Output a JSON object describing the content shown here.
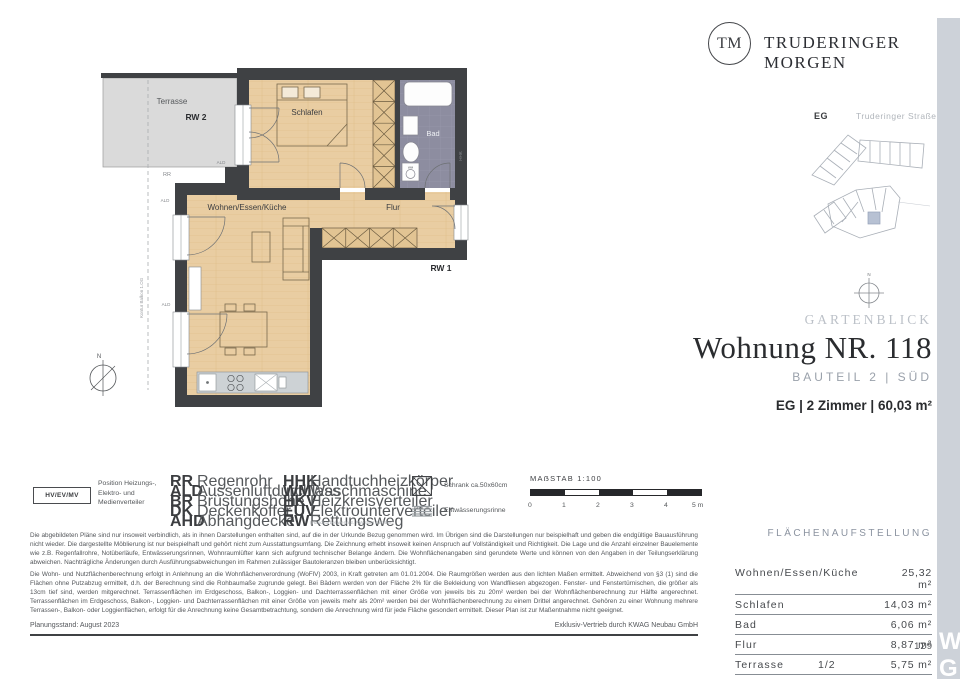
{
  "brand": {
    "initials": "TM",
    "name": "TRUDERINGER MORGEN"
  },
  "sitemap": {
    "floor": "EG",
    "street": "Truderinger Straße"
  },
  "title_block": {
    "category": "GARTENBLICK",
    "title": "Wohnung NR. 118",
    "subtitle": "BAUTEIL 2 | SÜD",
    "summary": "EG | 2 Zimmer | 60,03 m²"
  },
  "plan": {
    "terrasse": "Terrasse",
    "rw2": "RW 2",
    "schlafen": "Schlafen",
    "bad": "Bad",
    "wohnen": "Wohnen/Essen/Küche",
    "flur": "Flur",
    "rw1": "RW 1",
    "rr": "RR",
    "ald": "ALD",
    "wm": "WM",
    "hhk": "HHK",
    "north": "N",
    "kontur": "Kontur Balkon 1.OG"
  },
  "legend": {
    "hv_box": "HV/EV/MV",
    "hv_label_1": "Position Heizungs-,",
    "hv_label_2": "Elektro- und",
    "hv_label_3": "Medienverteiler",
    "col1": [
      {
        "a": "RR",
        "t": "Regenrohr"
      },
      {
        "a": "ALD",
        "t": "Aussenluftdurchlass"
      },
      {
        "a": "BR",
        "t": "Brüstungshöhe"
      },
      {
        "a": "DK",
        "t": "Deckenkoffer"
      },
      {
        "a": "AHD",
        "t": "Abhangdecke"
      }
    ],
    "col2": [
      {
        "a": "HHK",
        "t": "Handtuchheizkörper"
      },
      {
        "a": "WM",
        "t": "Waschmaschine"
      },
      {
        "a": "HKV",
        "t": "Heizkreisverteiler"
      },
      {
        "a": "EUV",
        "t": "Elektrounterverteiler"
      },
      {
        "a": "RW",
        "t": "Rettungsweg"
      }
    ],
    "rw_note": "(Handkurbel wenn 2. RW über Fenster)",
    "schrank": "Schrank ca.50x60cm",
    "rinne": "Entwässerungsrinne",
    "scale_title": "MAẞSTAB 1:100",
    "ticks": [
      "0",
      "1",
      "2",
      "3",
      "4",
      "5 m"
    ]
  },
  "disclaimer": {
    "p1": "Die abgebildeten Pläne sind nur insoweit verbindlich, als in ihnen Darstellungen enthalten sind, auf die in der Urkunde Bezug genommen wird. Im Übrigen sind die Darstellungen nur beispielhaft und geben die endgültige Bauausführung nicht wieder. Die dargestellte Möblierung ist nur beispielhaft und gehört nicht zum Ausstattungsumfang. Die Zeichnung erhebt insoweit keinen Anspruch auf Vollständigkeit und Richtigkeit. Die Lage und die Anzahl einzelner Bauelemente wie z.B. Regenfallrohre, Notüberläufe, Entwässerungsrinnen, Wohnraumlüfter kann sich aufgrund technischer Belange ändern. Die Wohnflächenangaben sind gerundete Werte und können von den Angaben in der Teilungserklärung abweichen. Nachträgliche Änderungen durch Ausführungsabweichungen im Rahmen zulässiger Bautoleranzen bleiben unberücksichtigt.",
    "p2": "Die Wohn- und Nutzflächenberechnung erfolgt in Anlehnung an die Wohnflächenverordnung (WoFlV) 2003, in Kraft getreten am 01.01.2004. Die Raumgrößen werden aus den lichten Maßen ermittelt. Abweichend von §3 (1) sind die Flächen ohne Putzabzug ermittelt, d.h. der Berechnung sind die Rohbaumaße zugrunde gelegt. Bei Bädern werden von der Fläche 2% für die Bekleidung von Wandfliesen abgezogen. Fenster- und Fenstertürnischen, die größer als 13cm tief sind, werden mitgerechnet. Terrassenflächen im Erdgeschoss, Balkon-, Loggien- und Dachterrassenflächen mit einer Größe von jeweils bis zu 20m² werden bei der Wohnflächenberechnung zur Hälfte angerechnet. Terrassenflächen im Erdgeschoss, Balkon-, Loggien- und Dachterrassenflächen mit einer Größe von jeweils mehr als 20m² werden bei der Wohnflächenberechnung zu einem Drittel angerechnet. Gehören zu einer Wohnung mehrere Terrassen-, Balkon- oder Loggienflächen, erfolgt für die Anrechnung keine Gesamtbetrachtung, sondern die Anrechnung wird für jede Fläche gesondert ermittelt. Dieser Plan ist zur Maßentnahme nicht geeignet."
  },
  "footer": {
    "left": "Planungsstand: August 2023",
    "right": "Exklusiv-Vertrieb durch KWAG Neubau GmbH",
    "page": "129"
  },
  "area": {
    "title": "FLÄCHENAUFSTELLUNG",
    "rows": [
      {
        "label": "Wohnen/Essen/Küche",
        "factor": "",
        "value": "25,32 m²"
      },
      {
        "label": "Schlafen",
        "factor": "",
        "value": "14,03 m²"
      },
      {
        "label": "Bad",
        "factor": "",
        "value": "6,06 m²"
      },
      {
        "label": "Flur",
        "factor": "",
        "value": "8,87 m²"
      },
      {
        "label": "Terrasse",
        "factor": "1/2",
        "value": "5,75 m²"
      }
    ]
  },
  "watermark": {
    "l1": "W",
    "l2": "G"
  }
}
